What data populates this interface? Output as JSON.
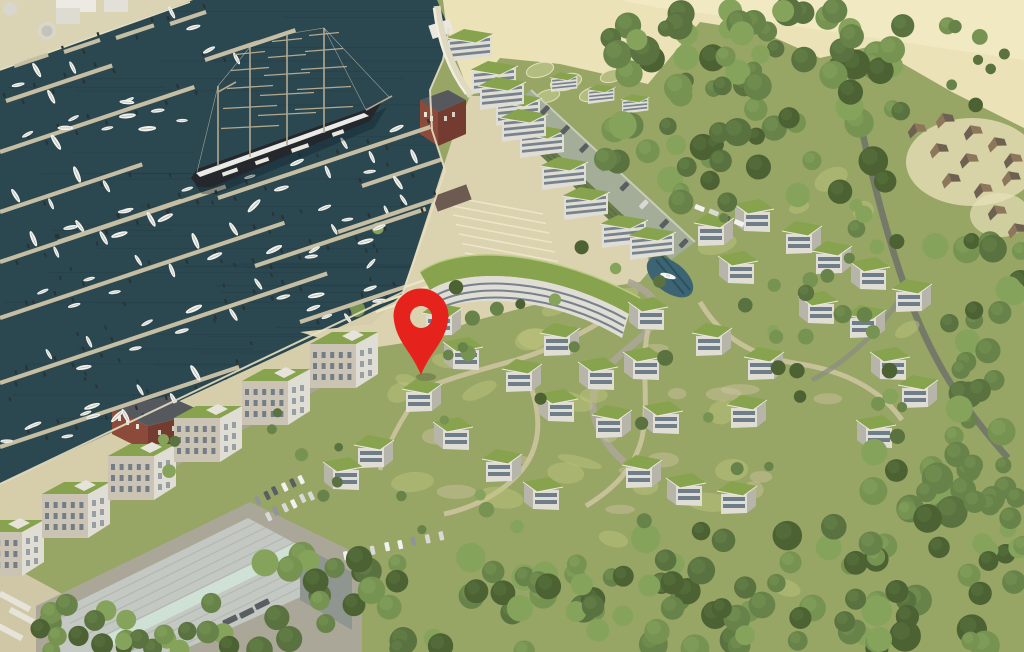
{
  "marker": {
    "name": "location-pin",
    "color": "#e5231c",
    "x": 421,
    "tip_y": 375,
    "head_cy": 314,
    "head_r": 27.5,
    "hole_r": 11
  },
  "colors": {
    "water": "#2b4750",
    "waterLine": "#0c2228",
    "waterEdge": "#e6dfc2",
    "quay": "#dbd4b4",
    "sand": "#ebe2b8",
    "sandBright": "#f3ecc6",
    "shore": "#d6cdab",
    "plaza": "#dbd2af",
    "steps": "#efe8cd",
    "grass": "#97a565",
    "grassLight": "#bdc37d",
    "path": "#cfc6a2",
    "road": "#aaa695",
    "forestRoad": "#747968",
    "roofGreen": "#87a34e",
    "roofGreenLight": "#a9bd6b",
    "wall": "#dfddd4",
    "wallShade": "#b7b5aa",
    "window": "#5b6c7a",
    "brick": "#8c4a3a",
    "brickSide": "#743c30",
    "darkRoof": "#55585c",
    "garageWall": "#68794b",
    "garageDeck": "#a3ad97",
    "whRoof": "#c4c8c2",
    "whRidge": "#afb4ae",
    "whStripe": "#cfe0d4",
    "apron": "#aaa798",
    "pier": "#c6bea2",
    "piling": "#2b3236",
    "boat": "#f2f2ed",
    "shipHull": "#24272c",
    "shipStripe": "#eaeae6",
    "mast": "#b4a98f",
    "pond": "#3c6472",
    "pondDark": "#2c515e",
    "cabinRoofA": "#6f6152",
    "cabinRoofB": "#8d7659",
    "treeShades": [
      "#4d6233",
      "#5a7240",
      "#68834a",
      "#779352",
      "#86a35c"
    ],
    "carShades": [
      "#f1f1ef",
      "#d8d8d5",
      "#595e62",
      "#90959a"
    ]
  },
  "marina": {
    "pierAngleDeg": -18.5,
    "piers": [
      {
        "x": 6,
        "y": 101,
        "len": 112
      },
      {
        "x": 0,
        "y": 152,
        "len": 205
      },
      {
        "x": 0,
        "y": 212,
        "len": 150
      },
      {
        "x": 0,
        "y": 262,
        "len": 238
      },
      {
        "x": 0,
        "y": 318,
        "len": 300
      },
      {
        "x": 0,
        "y": 383,
        "len": 345
      },
      {
        "x": 0,
        "y": 447,
        "len": 252
      },
      {
        "x": 58,
        "y": 242,
        "len": 130
      },
      {
        "x": 218,
        "y": 198,
        "len": 224
      },
      {
        "x": 255,
        "y": 266,
        "len": 180
      },
      {
        "x": 300,
        "y": 322,
        "len": 118
      },
      {
        "x": 338,
        "y": 232,
        "len": 104
      },
      {
        "x": 362,
        "y": 186,
        "len": 86
      }
    ],
    "quayStubs": [
      {
        "x": 14,
        "y": 66,
        "len": 36
      },
      {
        "x": 64,
        "y": 52,
        "len": 38
      },
      {
        "x": 116,
        "y": 38,
        "len": 40
      },
      {
        "x": 170,
        "y": 24,
        "len": 38
      },
      {
        "x": 205,
        "y": 60,
        "len": 56
      },
      {
        "x": 248,
        "y": 46,
        "len": 50
      }
    ],
    "pileZones": [
      {
        "x": 150,
        "y": 150,
        "w": 270,
        "h": 175,
        "n": 22
      },
      {
        "x": 0,
        "y": 230,
        "w": 150,
        "h": 205,
        "n": 18
      },
      {
        "x": 215,
        "y": 335,
        "w": 150,
        "h": 55,
        "n": 10
      }
    ],
    "freeBoatZones": [
      {
        "x": 5,
        "y": 405,
        "w": 200,
        "h": 62,
        "n": 9
      },
      {
        "x": 250,
        "y": 162,
        "w": 160,
        "h": 155,
        "n": 7
      },
      {
        "x": 60,
        "y": 78,
        "w": 160,
        "h": 58,
        "n": 5
      }
    ]
  },
  "resort": {
    "houses": [
      [
        712,
        228,
        1
      ],
      [
        756,
        214,
        2
      ],
      [
        800,
        236,
        1
      ],
      [
        740,
        266,
        2
      ],
      [
        830,
        256,
        1
      ],
      [
        872,
        272,
        2
      ],
      [
        910,
        294,
        1
      ],
      [
        820,
        306,
        2
      ],
      [
        864,
        320,
        1
      ],
      [
        650,
        312,
        2
      ],
      [
        710,
        338,
        1
      ],
      [
        645,
        362,
        2
      ],
      [
        762,
        362,
        1
      ],
      [
        558,
        338,
        1
      ],
      [
        600,
        372,
        2
      ],
      [
        520,
        374,
        1
      ],
      [
        560,
        404,
        2
      ],
      [
        610,
        420,
        1
      ],
      [
        665,
        416,
        2
      ],
      [
        745,
        410,
        1
      ],
      [
        892,
        362,
        2
      ],
      [
        916,
        390,
        1
      ],
      [
        465,
        352,
        2
      ],
      [
        420,
        394,
        1
      ],
      [
        455,
        432,
        2
      ],
      [
        372,
        450,
        1
      ],
      [
        345,
        472,
        2
      ],
      [
        500,
        464,
        1
      ],
      [
        545,
        492,
        2
      ],
      [
        640,
        470,
        1
      ],
      [
        688,
        488,
        2
      ],
      [
        735,
        496,
        1
      ],
      [
        878,
        430,
        2
      ],
      [
        440,
        318,
        1
      ]
    ],
    "apartmentBlocks": [
      [
        10,
        540
      ],
      [
        76,
        502
      ],
      [
        142,
        464
      ],
      [
        208,
        426
      ],
      [
        276,
        389
      ],
      [
        344,
        352
      ]
    ],
    "terraceBlocks": [
      [
        468,
        42
      ],
      [
        492,
        74
      ],
      [
        516,
        106
      ],
      [
        540,
        138
      ],
      [
        562,
        170
      ],
      [
        584,
        200
      ],
      [
        500,
        90
      ],
      [
        522,
        122
      ],
      [
        622,
        228
      ],
      [
        650,
        240
      ]
    ],
    "beachBoxes": [
      [
        563,
        80
      ],
      [
        600,
        92
      ],
      [
        634,
        102
      ]
    ],
    "cabins": [
      [
        916,
        128,
        1
      ],
      [
        944,
        118,
        2
      ],
      [
        972,
        130,
        1
      ],
      [
        938,
        148,
        2
      ],
      [
        968,
        158,
        1
      ],
      [
        996,
        142,
        2
      ],
      [
        1012,
        158,
        1
      ],
      [
        950,
        178,
        2
      ],
      [
        982,
        188,
        1
      ],
      [
        1010,
        176,
        2
      ],
      [
        996,
        210,
        1
      ],
      [
        1016,
        228,
        2
      ]
    ],
    "carRows": [
      {
        "x": 545,
        "y": 110,
        "dx": 19.9,
        "dy": 19.0,
        "n": 8,
        "angle": -46,
        "w": 10,
        "h": 5
      },
      {
        "x": 258,
        "y": 500,
        "dx": 8.6,
        "dy": -4.2,
        "n": 6,
        "angle": 64,
        "w": 9,
        "h": 4.5
      },
      {
        "x": 268,
        "y": 516,
        "dx": 8.6,
        "dy": -4.2,
        "n": 6,
        "angle": 64,
        "w": 9,
        "h": 4.5
      },
      {
        "x": 346,
        "y": 556,
        "dx": 13.5,
        "dy": -2.9,
        "n": 8,
        "angle": 78,
        "w": 9,
        "h": 4.5
      },
      {
        "x": 700,
        "y": 208,
        "dx": 13,
        "dy": 5,
        "n": 4,
        "angle": 22,
        "w": 10,
        "h": 5
      },
      {
        "x": 230,
        "y": 620,
        "dx": 16,
        "dy": -8,
        "n": 3,
        "angle": -26,
        "w": 15,
        "h": 6,
        "dark": true
      }
    ]
  },
  "forestZones": [
    {
      "x": 605,
      "y": 10,
      "w": 300,
      "h": 195,
      "n": 85,
      "rmin": 8,
      "rmax": 15
    },
    {
      "x": 935,
      "y": 230,
      "w": 89,
      "h": 330,
      "n": 42,
      "rmin": 8,
      "rmax": 14
    },
    {
      "x": 940,
      "y": 20,
      "w": 80,
      "h": 90,
      "n": 8,
      "rmin": 5,
      "rmax": 9
    },
    {
      "x": 850,
      "y": 440,
      "w": 174,
      "h": 212,
      "n": 40,
      "rmin": 9,
      "rmax": 16
    },
    {
      "x": 640,
      "y": 515,
      "w": 240,
      "h": 137,
      "n": 34,
      "rmin": 9,
      "rmax": 15
    },
    {
      "x": 255,
      "y": 555,
      "w": 420,
      "h": 100,
      "n": 55,
      "rmin": 9,
      "rmax": 15
    },
    {
      "x": 25,
      "y": 592,
      "w": 230,
      "h": 62,
      "n": 24,
      "rmin": 8,
      "rmax": 12
    },
    {
      "x": 770,
      "y": 205,
      "w": 130,
      "h": 200,
      "n": 16,
      "rmin": 6,
      "rmax": 10
    },
    {
      "x": 345,
      "y": 215,
      "w": 560,
      "h": 320,
      "n": 30,
      "rmin": 4.5,
      "rmax": 8
    },
    {
      "x": 150,
      "y": 380,
      "w": 200,
      "h": 130,
      "n": 10,
      "rmin": 4,
      "rmax": 7
    },
    {
      "x": 430,
      "y": 285,
      "w": 100,
      "h": 70,
      "n": 7,
      "rmin": 5,
      "rmax": 8
    }
  ],
  "texture": {
    "limePatches": {
      "x": 350,
      "y": 290,
      "w": 560,
      "h": 240,
      "n": 26
    },
    "sandPatches": {
      "x": 360,
      "y": 300,
      "w": 520,
      "h": 220,
      "n": 16
    },
    "waveLines": 48
  }
}
